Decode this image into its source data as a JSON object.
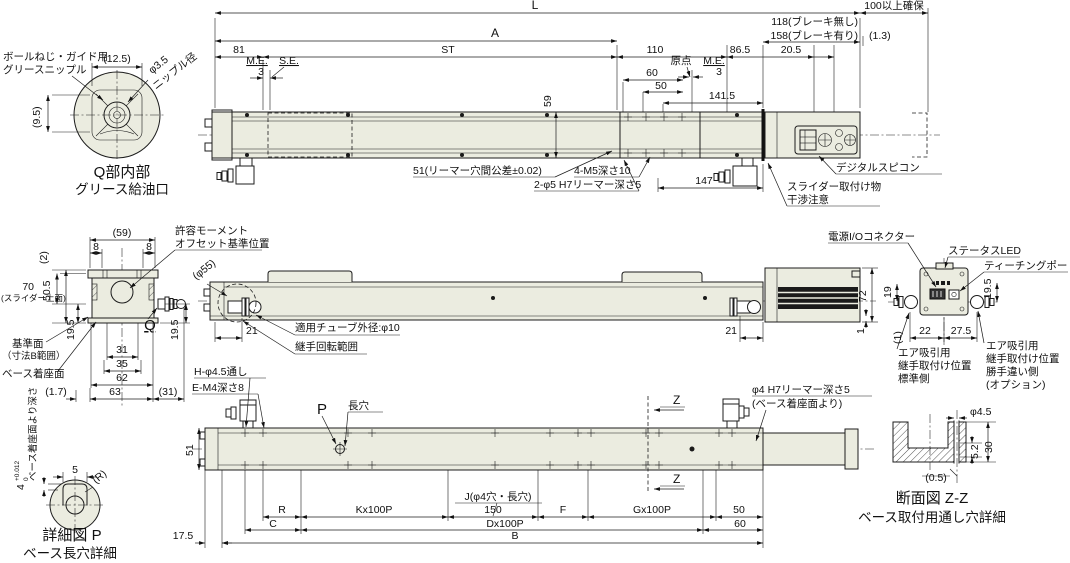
{
  "colors": {
    "body_fill": "#ebece0",
    "line": "#1c1c1c",
    "grille": "#1a1a1a"
  },
  "detail_q": {
    "nipple_note_line1": "ボールねじ・ガイド用",
    "nipple_note_line2": "グリースニップル",
    "dim_width": "(12.5)",
    "dim_height": "(9.5)",
    "nipple_dia_line1": "φ3.5",
    "nipple_dia_line2": "ニップル径",
    "caption_line1": "Q部内部",
    "caption_line2": "グリース給油口"
  },
  "top_view": {
    "dim_overall": "L",
    "dim_clearance": "100以上確保",
    "dim_a": "A",
    "dim_brake_none": "118(ブレーキ無し)",
    "dim_brake_with": "158(ブレーキ有り)",
    "dim_gap": "(1.3)",
    "dim_81": "81",
    "dim_stroke": "ST",
    "dim_110": "110",
    "dim_86_5": "86.5",
    "dim_20_5": "20.5",
    "label_me_left": "M.E.",
    "label_se": "S.E.",
    "dim_3_left": "3",
    "label_origin": "原点",
    "label_me_right": "M.E.",
    "dim_3_right": "3",
    "dim_60": "60",
    "dim_50": "50",
    "dim_141_5": "141.5",
    "dim_59": "59",
    "dim_147": "147",
    "note_reamer_pitch": "51(リーマー穴間公差±0.02)",
    "note_m5": "4-M5深さ10",
    "note_reamer": "2-φ5 H7リーマー深さ5",
    "note_spicon": "デジタルスピコン",
    "note_interference_line1": "スライダー取付け物",
    "note_interference_line2": "干渉注意"
  },
  "front_view": {
    "dim_59p": "(59)",
    "dim_8_left": "8",
    "dim_8_right": "8",
    "dim_2p": "(2)",
    "dim_50_5": "50.5",
    "dim_70": "70",
    "label_slider_top": "(スライダー上面)",
    "dim_19_5_left": "19.5",
    "dim_19_5_right": "19.5",
    "label_q": "Q",
    "dim_31": "31",
    "dim_35": "35",
    "dim_62": "62",
    "dim_63": "63",
    "dim_1_7": "(1.7)",
    "dim_31p": "(31)",
    "note_moment_line1": "許容モーメント",
    "note_moment_line2": "オフセット基準位置",
    "label_datum_line1": "基準面",
    "label_datum_line2": "（寸法B範囲）",
    "label_seating": "ベース着座面"
  },
  "side_view": {
    "dim_phi55": "(φ55)",
    "dim_21_left": "21",
    "note_tube": "適用チューブ外径:φ10",
    "note_rotation": "継手回転範囲",
    "dim_21_right": "21",
    "dim_72": "72",
    "dim_1": "1"
  },
  "end_view": {
    "note_power": "電源I/Oコネクター",
    "note_led": "ステータスLED",
    "note_teaching": "ティーチングポート",
    "dim_19": "19",
    "dim_19_5": "19.5",
    "dim_1p": "(1)",
    "dim_22": "22",
    "dim_27_5": "27.5",
    "note_air_std_line1": "エア吸引用",
    "note_air_std_line2": "継手取付け位置",
    "note_air_std_line3": "標準側",
    "note_air_opt_line1": "エア吸引用",
    "note_air_opt_line2": "継手取付け位置",
    "note_air_opt_line3": "勝手違い側",
    "note_air_opt_line4": "(オプション)"
  },
  "bottom_view": {
    "note_h_holes": "H-φ4.5通し",
    "note_e_holes": "E-M4深さ8",
    "label_p": "P",
    "label_slot": "長穴",
    "dim_51": "51",
    "note_reamer_line1": "φ4 H7リーマー深さ5",
    "note_reamer_line2": "(ベース着座面より)",
    "label_z_top": "Z",
    "label_z_bottom": "Z",
    "label_j": "J(φ4穴・長穴)",
    "dim_r": "R",
    "dim_c": "C",
    "dim_k": "Kx100P",
    "dim_150": "150",
    "dim_f": "F",
    "dim_g": "Gx100P",
    "dim_50": "50",
    "dim_60": "60",
    "dim_d": "Dx100P",
    "dim_b": "B",
    "dim_17_5": "17.5"
  },
  "detail_p": {
    "dim_5": "5",
    "dim_r": "(R)",
    "dim_4": "4",
    "tol_upper": "+0.012",
    "tol_lower": "0",
    "note_depth": "ベース着座面より深さ",
    "caption_line1": "詳細図 P",
    "caption_line2": "ベース長穴詳細"
  },
  "section_zz": {
    "dim_phi45": "φ4.5",
    "dim_5_2": "5.2",
    "dim_30": "30",
    "dim_0_5": "(0.5)",
    "caption_line1": "断面図 Z-Z",
    "caption_line2": "ベース取付用通し穴詳細"
  }
}
